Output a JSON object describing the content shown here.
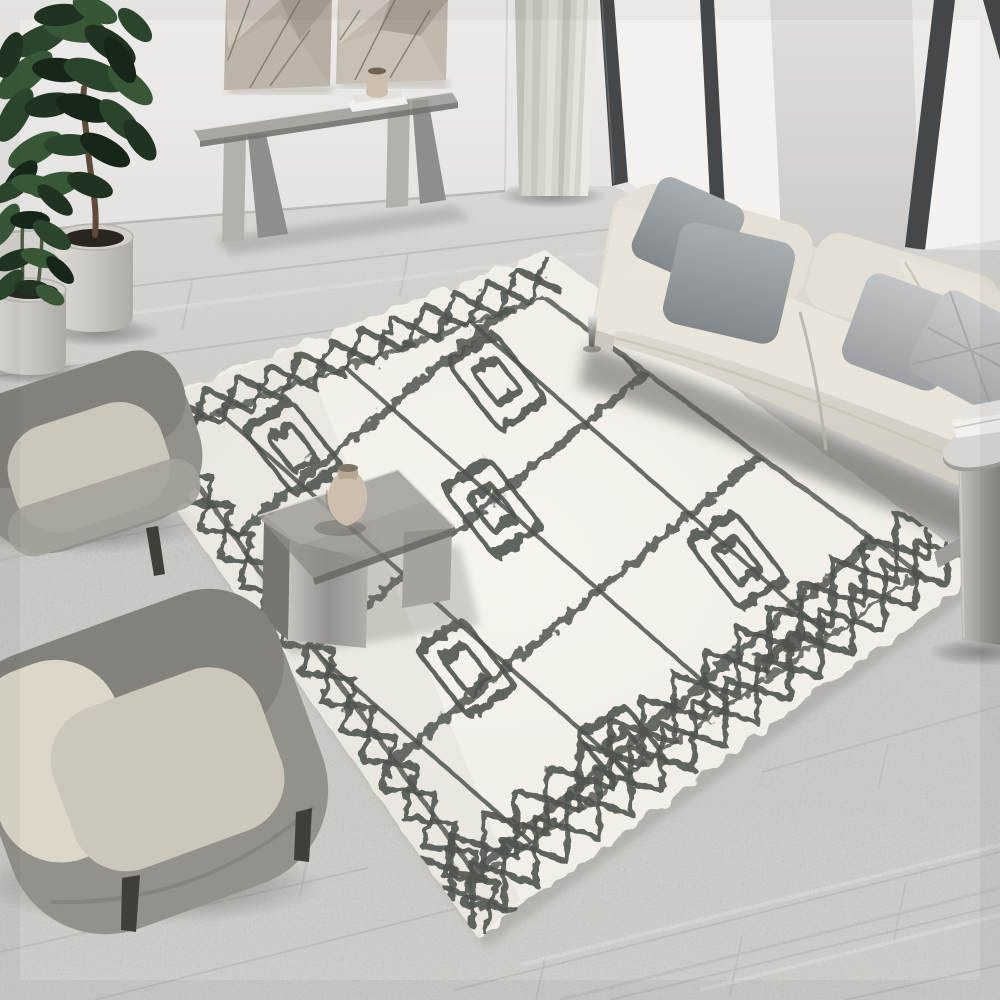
{
  "meta": {
    "description": "Top-down interior photo: modern living room with cream Moroccan shag rug, beige sofa, two grey armchairs, smoked-glass tables, plants, console and floor-to-ceiling windows",
    "image_type": "photograph-recreation"
  },
  "palette": {
    "wall": "#e9e8e6",
    "wallPillar": "#dbdad8",
    "windowFrame": "#45484a",
    "glass": "#f3f2ef",
    "curtain": "#d6d3cc",
    "floorSeam": "#bbb9b6",
    "rugBase": "#f1efe8",
    "rugPattern": "#50544f",
    "rugShadow": "#9d9b97",
    "sofaBody": "#ddd9ce",
    "sofaSeat": "#eae6db",
    "pillowDarkA": "#9ea3a6",
    "pillowDarkB": "#8f9598",
    "pillowLightA": "#b3b7ba",
    "pillowLightB": "#c0c3c5",
    "chairShell": "#93918b",
    "chairShellDark": "#83817c",
    "chairSeat": "#cbc7bb",
    "chairCushion": "#dcd7c9",
    "chairLeg": "#413e3a",
    "smokedGlass": "#8e8c88",
    "metalLight": "#b3b1ac",
    "metalDark": "#908e8a",
    "potSoil": "#2b251f",
    "trunk": "#5d4a38",
    "vase": "#cdbfae",
    "artPanelA": "#b7aea3",
    "artPanelB": "#c1b9ae",
    "books": "#f2f0ec"
  },
  "objects": [
    {
      "name": "wall-art",
      "label": "geometric relief wall panels"
    },
    {
      "name": "console-table",
      "label": "smoked glass console with steel legs"
    },
    {
      "name": "fiddle-leaf-plant",
      "label": "potted fiddle leaf fig"
    },
    {
      "name": "small-plant",
      "label": "small potted plant"
    },
    {
      "name": "curtain",
      "label": "floor length curtain"
    },
    {
      "name": "windows",
      "label": "floor-to-ceiling black framed windows"
    },
    {
      "name": "sofa",
      "label": "cream three-seat sofa with grey pillows"
    },
    {
      "name": "side-table",
      "label": "round metal side table with books"
    },
    {
      "name": "coffee-table",
      "label": "smoked glass waterfall coffee table with vase"
    },
    {
      "name": "rug",
      "label": "cream Moroccan diamond shag rug"
    },
    {
      "name": "armchair-1",
      "label": "grey barrel armchair"
    },
    {
      "name": "armchair-2",
      "label": "grey barrel armchair"
    }
  ],
  "rug": {
    "corners": "112,418 545,250 985,570 478,938",
    "innerOutline": "160,432 545,298 920,574 478,878",
    "matrix": [
      0.492,
      -0.191,
      0.61,
      0.867,
      112,
      418
    ],
    "strokeBorder": 6,
    "strokeLattice": 8,
    "strokeMotif": 9,
    "borders": [
      {
        "p": [
          112,
          418
        ],
        "q": [
          545,
          250
        ],
        "n": [
          0.362,
          0.932
        ],
        "zigs": 7,
        "d0": 8,
        "d1": 44,
        "pairs": 1,
        "gap": 30
      },
      {
        "p": [
          112,
          418
        ],
        "q": [
          478,
          938
        ],
        "n": [
          0.818,
          -0.576
        ],
        "zigs": 9,
        "d0": 8,
        "d1": 48,
        "pairs": 1,
        "gap": 30
      },
      {
        "p": [
          478,
          938
        ],
        "q": [
          985,
          570
        ],
        "n": [
          -0.587,
          -0.809
        ],
        "zigs": 8,
        "d0": 10,
        "d1": 64,
        "pairs": 2,
        "gap": 34
      }
    ],
    "lattice": {
      "fam1": {
        "cot": 0.5317,
        "xs": [
          -90,
          160,
          410,
          660,
          910,
          1160,
          1410
        ],
        "yRange": [
          -60,
          680
        ]
      },
      "fam2": {
        "tan": -0.1584,
        "ys": [
          30,
          160,
          290,
          420,
          550
        ],
        "xRange": [
          -80,
          1480
        ]
      }
    },
    "motifs": [
      {
        "x": 255,
        "y": 91
      },
      {
        "x": 656,
        "y": 102
      },
      {
        "x": 506,
        "y": 215
      },
      {
        "x": 838,
        "y": 349
      },
      {
        "x": 284,
        "y": 351
      },
      {
        "x": 1060,
        "y": 199
      },
      {
        "x": 446,
        "y": 486
      },
      {
        "x": 820,
        "y": 483
      },
      {
        "x": 941,
        "y": 106
      }
    ],
    "motifOuter": [
      110,
      78
    ],
    "motifInner": [
      54,
      38
    ],
    "motifRot": -6
  },
  "floor": {
    "seams": [
      [
        0,
        302,
        620,
        228
      ],
      [
        0,
        376,
        705,
        279
      ],
      [
        0,
        464,
        430,
        380
      ],
      [
        0,
        560,
        195,
        522
      ],
      [
        0,
        688,
        245,
        630
      ],
      [
        0,
        952,
        368,
        868
      ],
      [
        95,
        1000,
        470,
        905
      ],
      [
        455,
        990,
        1000,
        852
      ],
      [
        610,
        1000,
        1000,
        905
      ],
      [
        845,
        1000,
        1000,
        965
      ],
      [
        762,
        772,
        1000,
        706
      ]
    ],
    "crossSeams": [
      [
        192,
        282,
        182,
        330
      ],
      [
        408,
        254,
        400,
        296
      ],
      [
        86,
        424,
        76,
        470
      ],
      [
        62,
        642,
        50,
        700
      ],
      [
        310,
        844,
        300,
        897
      ],
      [
        545,
        958,
        536,
        1000
      ],
      [
        742,
        936,
        730,
        995
      ],
      [
        906,
        882,
        894,
        940
      ],
      [
        888,
        744,
        878,
        790
      ]
    ],
    "streaksLight": [
      [
        0,
        330,
        620,
        250
      ],
      [
        0,
        430,
        400,
        365
      ],
      [
        0,
        740,
        300,
        668
      ],
      [
        520,
        965,
        1000,
        845
      ],
      [
        700,
        990,
        1000,
        915
      ]
    ],
    "streaksDark": [
      [
        0,
        505,
        260,
        452
      ],
      [
        560,
        1000,
        1000,
        888
      ]
    ]
  },
  "plants": {
    "shades": [
      "#1f3320",
      "#2b452c",
      "#375737",
      "#16271a"
    ],
    "big": [
      [
        40,
        40,
        30,
        13,
        -25,
        1
      ],
      [
        75,
        28,
        32,
        14,
        10,
        2
      ],
      [
        110,
        45,
        30,
        13,
        35,
        0
      ],
      [
        25,
        75,
        34,
        14,
        -40,
        2
      ],
      [
        60,
        70,
        28,
        12,
        5,
        3
      ],
      [
        95,
        75,
        33,
        14,
        20,
        1
      ],
      [
        130,
        85,
        28,
        12,
        40,
        2
      ],
      [
        15,
        115,
        30,
        13,
        -60,
        1
      ],
      [
        50,
        105,
        26,
        12,
        -10,
        0
      ],
      [
        85,
        108,
        30,
        13,
        15,
        3
      ],
      [
        120,
        120,
        27,
        12,
        45,
        1
      ],
      [
        35,
        150,
        30,
        13,
        -30,
        2
      ],
      [
        70,
        145,
        26,
        11,
        0,
        1
      ],
      [
        105,
        150,
        28,
        12,
        30,
        3
      ],
      [
        140,
        140,
        24,
        11,
        55,
        0
      ],
      [
        55,
        185,
        26,
        12,
        -15,
        2
      ],
      [
        90,
        185,
        24,
        11,
        20,
        0
      ],
      [
        20,
        180,
        24,
        11,
        -50,
        3
      ],
      [
        120,
        60,
        26,
        11,
        60,
        3
      ],
      [
        60,
        15,
        26,
        11,
        -5,
        0
      ],
      [
        95,
        10,
        24,
        11,
        25,
        2
      ],
      [
        10,
        55,
        24,
        11,
        -70,
        0
      ],
      [
        135,
        25,
        22,
        10,
        45,
        1
      ]
    ],
    "small": [
      [
        10,
        190,
        22,
        9,
        -30,
        1
      ],
      [
        35,
        185,
        24,
        10,
        10,
        2
      ],
      [
        55,
        200,
        22,
        9,
        40,
        0
      ],
      [
        5,
        225,
        24,
        10,
        -60,
        2
      ],
      [
        30,
        220,
        20,
        9,
        0,
        3
      ],
      [
        52,
        235,
        22,
        10,
        35,
        1
      ],
      [
        15,
        260,
        22,
        9,
        -20,
        0
      ],
      [
        40,
        258,
        20,
        9,
        15,
        2
      ],
      [
        60,
        270,
        18,
        8,
        45,
        3
      ],
      [
        8,
        285,
        20,
        9,
        -45,
        1
      ],
      [
        32,
        288,
        18,
        8,
        5,
        0
      ],
      [
        50,
        295,
        16,
        8,
        30,
        2
      ]
    ]
  }
}
